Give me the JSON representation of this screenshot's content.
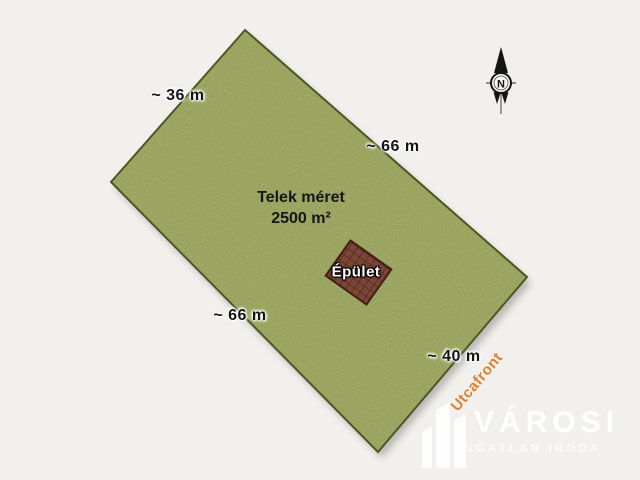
{
  "background": "#f1f0ec",
  "parcel": {
    "title": "Telek méret",
    "area": "2500 m²",
    "fill": "#808f44",
    "border": "#4d5626",
    "dims": {
      "top_left": "~ 36 m",
      "top_right": "~ 66 m",
      "bottom_left": "~ 66 m",
      "bottom_right": "~ 40 m"
    }
  },
  "building": {
    "label": "Épület",
    "fill": "#7a4636",
    "grid_line": "#50251d",
    "border": "#401f16"
  },
  "street_front": {
    "label": "Utcafront",
    "color": "#e07e2c"
  },
  "compass": {
    "north_label": "N"
  },
  "brand": {
    "name": "VÁROSI",
    "subtitle": "INGATLAN IRODA",
    "color": "#ffffff"
  }
}
